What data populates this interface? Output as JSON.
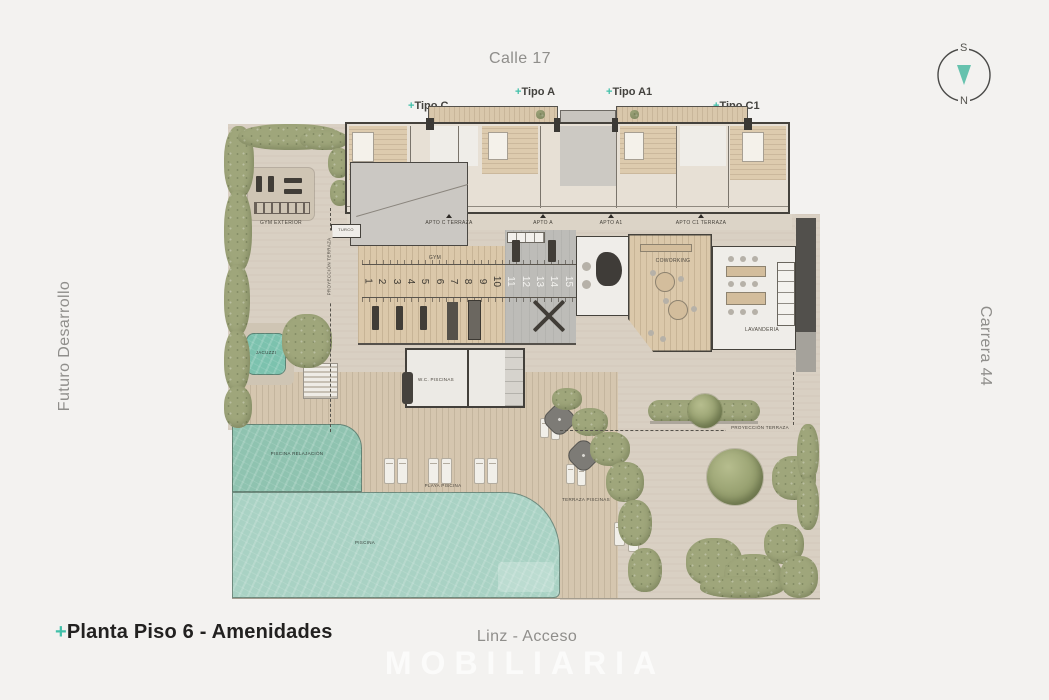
{
  "plus": "+",
  "streets": {
    "top": "Calle 17",
    "left": "Futuro Desarrollo",
    "right": "Carrera 44",
    "bottom": "Linz - Acceso"
  },
  "compass": {
    "top": "S",
    "bottom": "N"
  },
  "title": {
    "text": "Planta Piso 6 - Amenidades"
  },
  "watermark": "MOBILIARIA",
  "unit_types": [
    {
      "label": "Tipo C"
    },
    {
      "label": "Tipo A"
    },
    {
      "label": "Tipo A1"
    },
    {
      "label": "Tipo C1"
    }
  ],
  "plan": {
    "apartments": [
      {
        "label": "APTO C TERRAZA"
      },
      {
        "label": "APTO A"
      },
      {
        "label": "APTO A1"
      },
      {
        "label": "APTO C1 TERRAZA"
      }
    ],
    "areas": {
      "gym_exterior": "GYM EXTERIOR",
      "turco": "TURCO",
      "gym": "GYM",
      "coworking": "COWORKING",
      "lavanderia": "LAVANDERIA",
      "wc_piscinas": "W.C. PISCINAS",
      "jacuzzi": "JACUZZI",
      "piscina_relajacion": "PISCINA RELAJACIÓN",
      "playa_piscina": "PLAYA PISCINA",
      "piscina": "PISCINA",
      "terraza_piscinas": "TERRAZA PISCINAS",
      "proyeccion_terraza": "PROYECCIÓN TERRAZA"
    },
    "gym_stalls": [
      "1",
      "2",
      "3",
      "4",
      "5",
      "6",
      "7",
      "8",
      "9",
      "10",
      "11",
      "12",
      "13",
      "14",
      "15"
    ]
  },
  "colors": {
    "accent": "#41c0a9",
    "terrace": "#d9d0c3",
    "deck": "#d5c6af",
    "water_main": "#a9d2c4",
    "water_relax": "#8fc3b0",
    "water_jacuzzi": "#7cc2ae",
    "green": "#9fa67b",
    "wall": "#45423c",
    "street_text": "#8f8e8b"
  }
}
